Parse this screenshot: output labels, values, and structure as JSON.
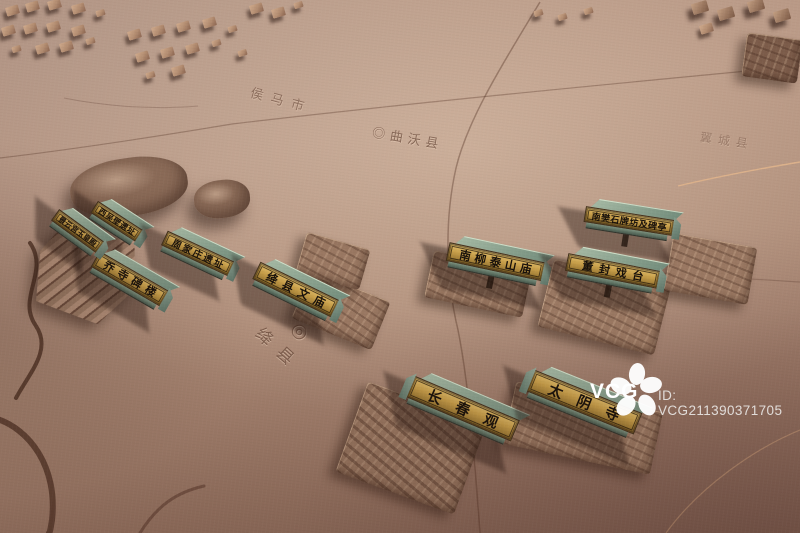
{
  "scene": {
    "description": "Aerial photograph of a carved stone relief map model of Jiang County with bronze heritage-site nameplates",
    "ground_color": "#b08f7a",
    "plaque_face_color": "#c79e49",
    "plaque_body_color": "#8ba08f",
    "incised_text_color": "#5a382a"
  },
  "plaques": [
    {
      "label": "景云宫玉皇殿"
    },
    {
      "label": "西吴壁遗址"
    },
    {
      "label": "周家庄遗址"
    },
    {
      "label": "乔寺碑楼"
    },
    {
      "label": "绛县文庙"
    },
    {
      "label": "南柳泰山庙"
    },
    {
      "label": "南樊石牌坊及碑亭"
    },
    {
      "label": "董封戏台"
    },
    {
      "label": "长春观"
    },
    {
      "label": "太阴寺"
    }
  ],
  "map_labels": {
    "houma": "侯马市",
    "quwo": "◎曲沃县",
    "yicheng": "翼城县",
    "county_marker": "◎",
    "county": "绛县"
  },
  "watermark": {
    "brand": "VCG",
    "id_text": "ID: VCG211390371705"
  }
}
